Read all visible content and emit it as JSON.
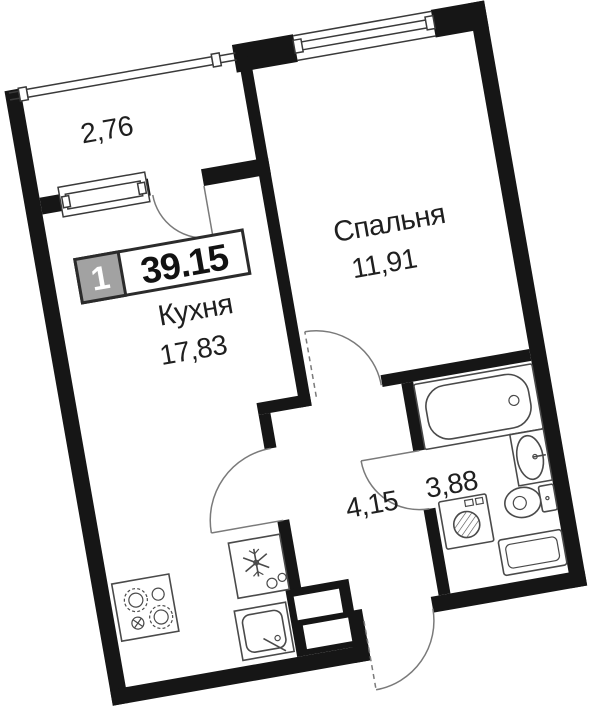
{
  "plan": {
    "badge": {
      "rooms": "1",
      "total_area": "39.15"
    },
    "rooms": {
      "balcony": {
        "area": "2,76"
      },
      "kitchen": {
        "name": "Кухня",
        "area": "17,83"
      },
      "bedroom": {
        "name": "Спальня",
        "area": "11,91"
      },
      "hallway": {
        "area": "4,15"
      },
      "bathroom": {
        "area": "3,88"
      }
    },
    "rotation_deg": -10,
    "colors": {
      "walls": "#161616",
      "background": "#ffffff",
      "fixture_line": "#4a4a4a",
      "arc_line": "#7a7a7a",
      "glazing_line": "#3a3a3a",
      "badge_gray": "#a2a2a2",
      "badge_border": "#2b2b2b",
      "badge_number": "#ffffff",
      "ink": "#1f1f1f"
    }
  }
}
